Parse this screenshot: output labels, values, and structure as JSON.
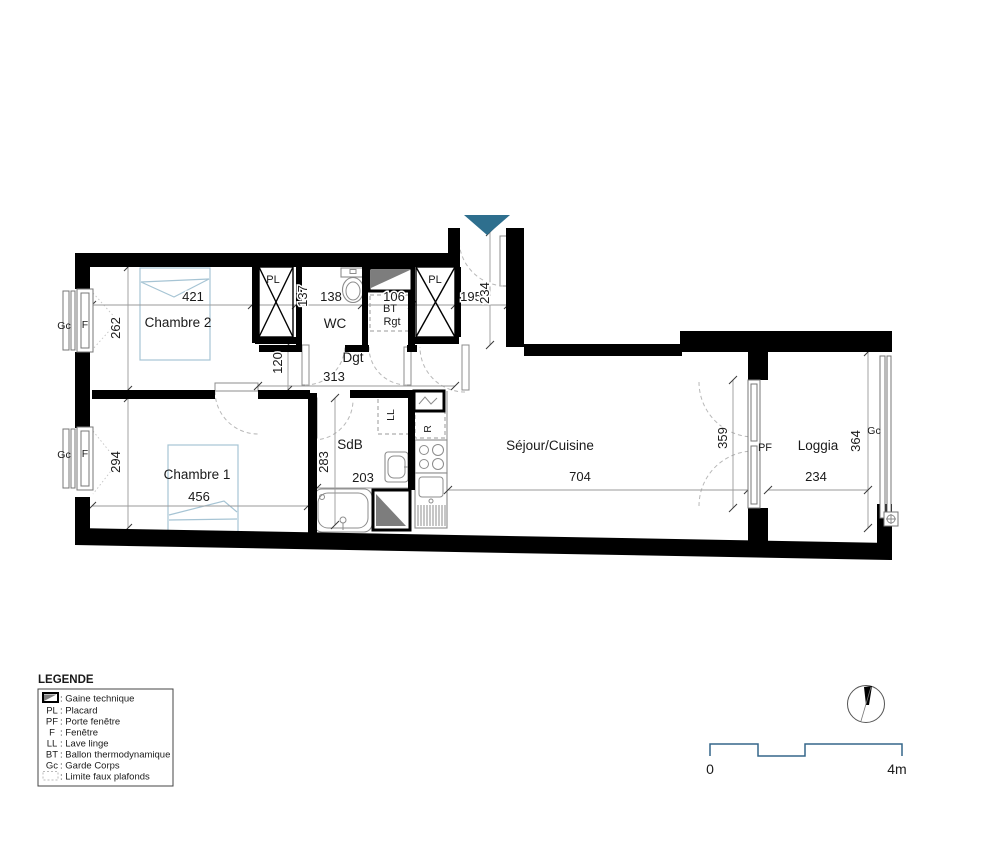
{
  "colors": {
    "wall": "#000000",
    "entrance_arrow": "#2e6f8e",
    "scalebar": "#35678a",
    "bed": "#a6c4d4",
    "gaine_fill": "#7d7d7d"
  },
  "rooms": {
    "chambre2": {
      "name": "Chambre 2",
      "width": "421",
      "depth": "262"
    },
    "chambre1": {
      "name": "Chambre 1",
      "width": "456",
      "depth": "294"
    },
    "wc": {
      "name": "WC",
      "width": "138",
      "closet_width": "137"
    },
    "bt_rgt": {
      "abbr1": "BT",
      "abbr2": "Rgt",
      "width": "106"
    },
    "entry": {
      "width": "195",
      "depth": "234"
    },
    "dgt": {
      "name": "Dgt",
      "length": "313",
      "width": "120"
    },
    "sdb": {
      "name": "SdB",
      "depth": "283",
      "width": "203"
    },
    "sejour": {
      "name": "Séjour/Cuisine",
      "length": "704",
      "bay_height": "359"
    },
    "loggia": {
      "name": "Loggia",
      "width": "234",
      "depth": "364"
    }
  },
  "tags": {
    "pl": "PL",
    "pf": "PF",
    "f": "F",
    "gc": "Gc",
    "ll": "LL",
    "r": "R"
  },
  "legend": {
    "title": "LEGENDE",
    "gaine_label": ": Gaine technique",
    "faux_label": ": Limite faux plafonds",
    "items": [
      {
        "abbr": "PL",
        "label": ": Placard"
      },
      {
        "abbr": "PF",
        "label": ": Porte fenêtre"
      },
      {
        "abbr": "F",
        "label": ": Fenêtre"
      },
      {
        "abbr": "LL",
        "label": ": Lave linge"
      },
      {
        "abbr": "BT",
        "label": ": Ballon thermodynamique"
      },
      {
        "abbr": "Gc",
        "label": ": Garde Corps"
      }
    ]
  },
  "scalebar": {
    "zero": "0",
    "four": "4m"
  }
}
